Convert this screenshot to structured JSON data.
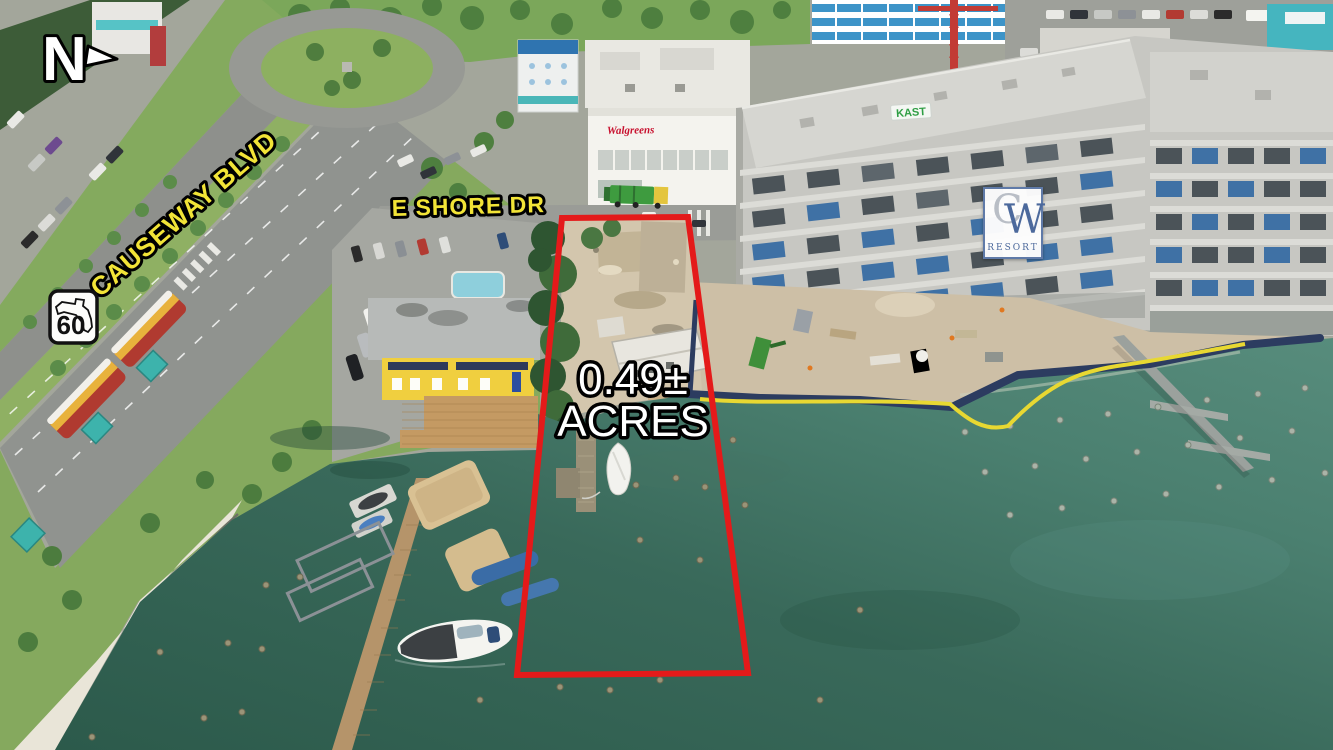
{
  "annotations": {
    "north_letter": "N",
    "causeway_blvd": "CAUSEWAY BLVD",
    "route_number": "60",
    "e_shore_dr": "E SHORE DR",
    "acres_value": "0.49±",
    "acres_unit": "ACRES"
  },
  "signs": {
    "resort_initial_c": "C",
    "resort_initial_w": "W",
    "resort_word": "RESORT",
    "contractor": "KAST",
    "pharmacy": "Walgreens"
  },
  "colors": {
    "parcel_outline": "#e41a1a",
    "street_label": "#f2e437",
    "area_label": "#ffffff",
    "water_deep": "#2c5a4b",
    "water_shallow": "#578c7c",
    "resort_blue": "#4c699c"
  }
}
